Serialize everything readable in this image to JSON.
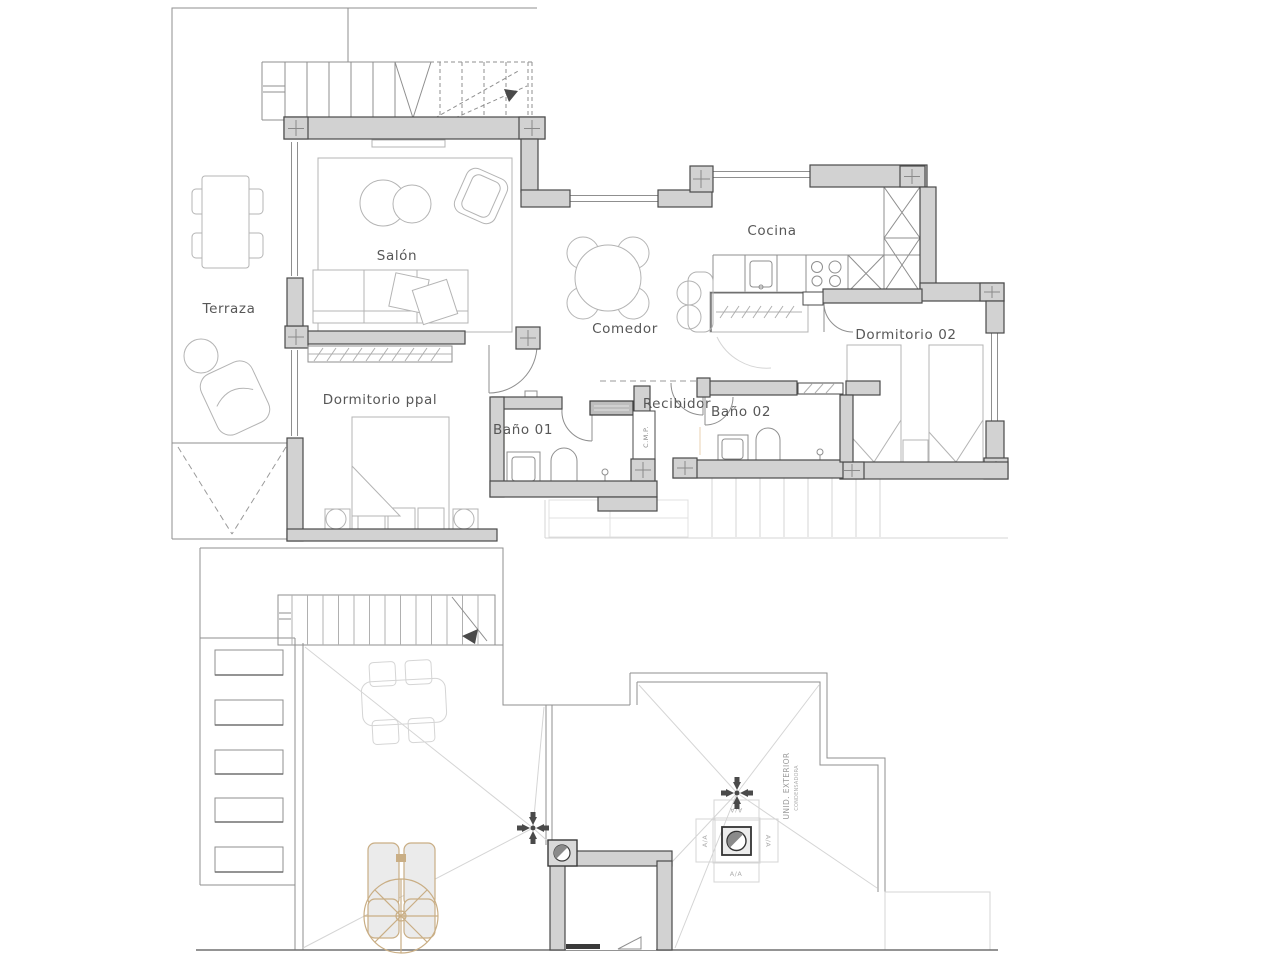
{
  "floor_plan": {
    "labels": {
      "terraza": "Terraza",
      "salon": "Salón",
      "cocina": "Cocina",
      "comedor": "Comedor",
      "dormitorio02": "Dormitorio 02",
      "dormitorio_ppal": "Dormitorio ppal",
      "bano01": "Baño 01",
      "recibidor": "Recibidor",
      "bano02": "Baño 02",
      "cmp": "C.M.P."
    }
  },
  "roof_plan": {
    "labels": {
      "unidad_exterior": "UNID. EXTERIOR",
      "condensadora": "CONDENSADORA",
      "aa": "A/A"
    }
  },
  "colors": {
    "wall_fill": "#d2d2d2",
    "wall_stroke": "#4a4a4a",
    "thin_line": "#8f8f8f",
    "furniture_line": "#b4b4b4",
    "faint_line": "#d5d5d5",
    "accent_tan": "#c9ae85",
    "label_text": "#575757",
    "symbol_dark": "#4a4a4a",
    "background": "#ffffff"
  }
}
